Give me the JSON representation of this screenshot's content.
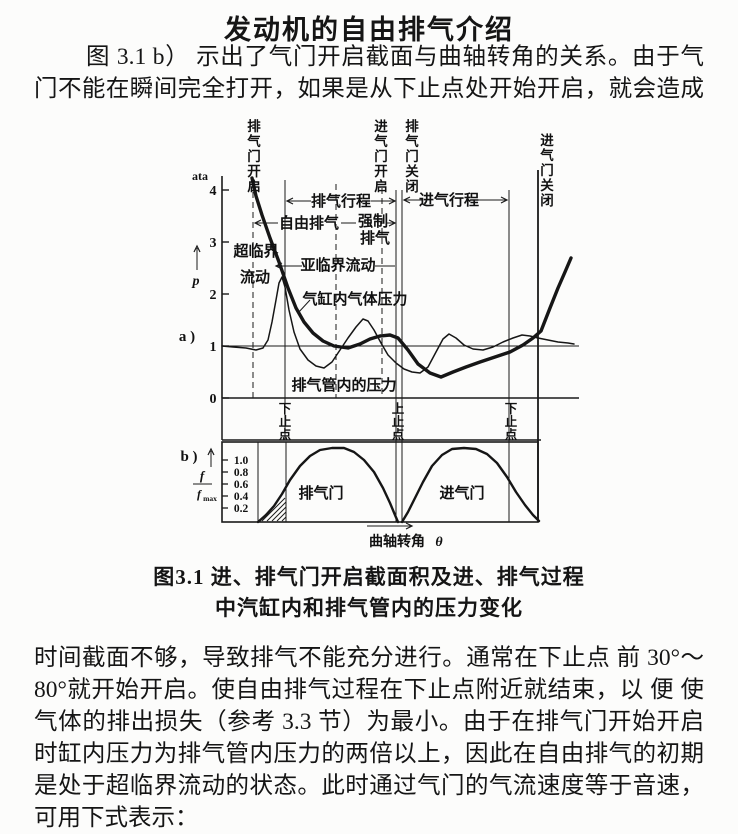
{
  "page": {
    "title": "发动机的自由排气介绍",
    "para1_lines": [
      "图 3.1 b） 示出了气门开启截面与曲轴转角的关系。由于气",
      "门不能在瞬间完全打开，如果是从下止点处开始开启，就会造成"
    ],
    "para2_lines": [
      "时间截面不够，导致排气不能充分进行。通常在下止点 前 30°～",
      "80°就开始开启。使自由排气过程在下止点附近就结束，以 便 使",
      "气体的排出损失（参考 3.3 节）为最小。由于在排气门开始开启",
      "时缸内压力为排气管内压力的两倍以上，因此在自由排气的初期",
      "是处于超临界流动的状态。此时通过气门的气流速度等于音速，",
      "可用下式表示："
    ],
    "caption_line1": "图3.1  进、排气门开启截面积及进、排气过程",
    "caption_line2": "中汽缸内和排气管内的压力变化"
  },
  "chart_data": {
    "type": "line",
    "title": "进、排气门开启截面积及进、排气过程中汽缸内和排气管内的压力变化",
    "subplot_a": {
      "ylabel": "p (ata)",
      "yticks": [
        0,
        1,
        2,
        3,
        4
      ],
      "ylim": [
        0,
        4.5
      ],
      "x_axis": "曲轴转角（无数值刻度，以事件线标注）",
      "events": [
        "排气门开启",
        "下止点",
        "进气门开启",
        "上止点 / 排气门关闭",
        "下止点",
        "进气门关闭"
      ],
      "regions": [
        "自由排气",
        "强制排气",
        "排气行程",
        "进气行程",
        "超临界流动",
        "亚临界流动"
      ],
      "series": [
        {
          "name": "气缸内气体压力",
          "approx_atm_at_events": [
            4.2,
            2.1,
            1.2,
            1.15,
            0.95,
            1.3
          ]
        },
        {
          "name": "排气管内的压力",
          "approx_atm_at_events": [
            1.0,
            2.35,
            1.0,
            1.1,
            1.05,
            1.0
          ]
        }
      ]
    },
    "subplot_b": {
      "ylabel": "f/fmax",
      "yticks": [
        0.2,
        0.4,
        0.6,
        0.8,
        1.0
      ],
      "xlabel": "曲轴转角 θ",
      "curves": [
        "排气门",
        "进气门"
      ],
      "description": "两条钟形开启截面曲线；排气门在下止点前开启（起始段为阴影区），上止点处排气门关闭、进气门开启，进气门在第二个下止点后关闭"
    }
  },
  "figure": {
    "unit_label": "ata",
    "p_label": "p",
    "panel_a": "a )",
    "panel_b": "b )",
    "axis_a": {
      "x": 224,
      "ytop": 176,
      "ybot": 398,
      "ticks": [
        {
          "t": "4",
          "y": 190
        },
        {
          "t": "3",
          "y": 242
        },
        {
          "t": "2",
          "y": 294
        },
        {
          "t": "1",
          "y": 346
        },
        {
          "t": "0",
          "y": 398
        }
      ]
    },
    "ref_y": 346,
    "base_y": 398,
    "strip_bot": 440,
    "x_left": 224,
    "x_right": 540,
    "x_end": 581,
    "b_box": {
      "x1": 224,
      "x2": 540,
      "y1": 442,
      "y2": 522
    },
    "b_ticks": [
      {
        "t": "1.0",
        "y": 460
      },
      {
        "t": "0.8",
        "y": 472
      },
      {
        "t": "0.6",
        "y": 484
      },
      {
        "t": "0.4",
        "y": 496
      },
      {
        "t": "0.2",
        "y": 508
      }
    ],
    "f_frac": {
      "top": "f",
      "bot": "f",
      "sub": "max"
    },
    "vlines": [
      {
        "x": 255,
        "y1": 182,
        "y2": 398,
        "dash": true
      },
      {
        "x": 287,
        "y1": 180,
        "y2": 440,
        "dash": false
      },
      {
        "x": 338,
        "y1": 184,
        "y2": 398,
        "dash": true
      },
      {
        "x": 384,
        "y1": 188,
        "y2": 398,
        "dash": true
      },
      {
        "x": 398,
        "y1": 190,
        "y2": 522,
        "dash": false
      },
      {
        "x": 404,
        "y1": 190,
        "y2": 522,
        "dash": false
      },
      {
        "x": 511,
        "y1": 190,
        "y2": 522,
        "dash": false
      },
      {
        "x": 540,
        "y1": 170,
        "y2": 522,
        "dash": false,
        "w": 1.8
      },
      {
        "x": 260,
        "y1": 442,
        "y2": 522,
        "dash": false
      },
      {
        "x": 288,
        "y1": 442,
        "y2": 522,
        "dash": false
      }
    ],
    "top_labels": [
      {
        "t": "排气门开启",
        "x": 256,
        "y": 131
      },
      {
        "t": "进气门开启",
        "x": 383,
        "y": 131
      },
      {
        "t": "排气门关闭",
        "x": 414,
        "y": 131
      },
      {
        "t": "进气门关闭",
        "x": 549,
        "y": 145
      }
    ],
    "dead_labels": [
      {
        "t": "下止点",
        "x": 287,
        "y": 413
      },
      {
        "t": "上止点",
        "x": 400,
        "y": 413
      },
      {
        "t": "下止点",
        "x": 513,
        "y": 413
      }
    ],
    "annotations": [
      {
        "t": "排气行程",
        "x": 343,
        "y": 206,
        "s": 15
      },
      {
        "t": "进气行程",
        "x": 451,
        "y": 205,
        "s": 15
      },
      {
        "t": "自由排气",
        "x": 311,
        "y": 228,
        "s": 15
      },
      {
        "t": "强制",
        "x": 375,
        "y": 226,
        "s": 15
      },
      {
        "t": "排气",
        "x": 377,
        "y": 243,
        "s": 15
      },
      {
        "t": "超临界",
        "x": 258,
        "y": 256,
        "s": 15
      },
      {
        "t": "流动",
        "x": 257,
        "y": 282,
        "s": 15
      },
      {
        "t": "亚临界流动",
        "x": 340,
        "y": 270,
        "s": 15
      },
      {
        "t": "气缸内气体压力",
        "x": 357,
        "y": 304,
        "s": 15
      },
      {
        "t": "排气管内的压力",
        "x": 346,
        "y": 390,
        "s": 15
      },
      {
        "t": "排气门",
        "x": 323,
        "y": 498,
        "s": 15
      },
      {
        "t": "进气门",
        "x": 464,
        "y": 498,
        "s": 15
      },
      {
        "t": "曲轴转角",
        "x": 399,
        "y": 546,
        "s": 14
      },
      {
        "t": "θ",
        "x": 441,
        "y": 546,
        "s": 14,
        "i": true
      }
    ],
    "arrows": [
      {
        "x1": 289,
        "y1": 201,
        "x2": 313,
        "y2": 201,
        "h": "l"
      },
      {
        "x1": 373,
        "y1": 201,
        "x2": 397,
        "y2": 201,
        "h": "r"
      },
      {
        "x1": 406,
        "y1": 200,
        "x2": 425,
        "y2": 200,
        "h": "l"
      },
      {
        "x1": 477,
        "y1": 200,
        "x2": 509,
        "y2": 200,
        "h": "r"
      },
      {
        "x1": 257,
        "y1": 223,
        "x2": 280,
        "y2": 223,
        "h": "l"
      },
      {
        "x1": 343,
        "y1": 223,
        "x2": 358,
        "y2": 223,
        "h": ""
      },
      {
        "x1": 389,
        "y1": 223,
        "x2": 397,
        "y2": 223,
        "h": "r"
      },
      {
        "x1": 278,
        "y1": 266,
        "x2": 304,
        "y2": 266,
        "h": "l"
      },
      {
        "x1": 377,
        "y1": 266,
        "x2": 397,
        "y2": 266,
        "h": ""
      },
      {
        "x1": 312,
        "y1": 300,
        "x2": 300,
        "y2": 313,
        "h": ""
      },
      {
        "x1": 369,
        "y1": 526,
        "x2": 414,
        "y2": 526,
        "h": "r"
      }
    ],
    "curve_cylinder": [
      [
        254,
        178
      ],
      [
        258,
        196
      ],
      [
        264,
        215
      ],
      [
        272,
        238
      ],
      [
        281,
        262
      ],
      [
        290,
        288
      ],
      [
        298,
        308
      ],
      [
        306,
        322
      ],
      [
        315,
        333
      ],
      [
        325,
        341
      ],
      [
        336,
        346
      ],
      [
        350,
        348
      ],
      [
        362,
        344
      ],
      [
        372,
        339
      ],
      [
        382,
        336
      ],
      [
        392,
        335
      ],
      [
        400,
        338
      ],
      [
        410,
        350
      ],
      [
        420,
        364
      ],
      [
        432,
        373
      ],
      [
        443,
        377
      ],
      [
        455,
        372
      ],
      [
        468,
        367
      ],
      [
        482,
        362
      ],
      [
        497,
        357
      ],
      [
        512,
        352
      ],
      [
        525,
        345
      ],
      [
        535,
        338
      ],
      [
        543,
        331
      ],
      [
        552,
        308
      ],
      [
        560,
        288
      ],
      [
        567,
        272
      ],
      [
        573,
        258
      ]
    ],
    "curve_pipe": [
      [
        224,
        346
      ],
      [
        235,
        347
      ],
      [
        248,
        348
      ],
      [
        258,
        350
      ],
      [
        265,
        348
      ],
      [
        270,
        340
      ],
      [
        274,
        322
      ],
      [
        278,
        300
      ],
      [
        281,
        283
      ],
      [
        284,
        277
      ],
      [
        287,
        287
      ],
      [
        291,
        310
      ],
      [
        296,
        332
      ],
      [
        302,
        349
      ],
      [
        310,
        360
      ],
      [
        318,
        366
      ],
      [
        326,
        368
      ],
      [
        334,
        362
      ],
      [
        342,
        350
      ],
      [
        350,
        338
      ],
      [
        358,
        327
      ],
      [
        365,
        319
      ],
      [
        370,
        321
      ],
      [
        376,
        330
      ],
      [
        383,
        343
      ],
      [
        390,
        355
      ],
      [
        398,
        363
      ],
      [
        406,
        369
      ],
      [
        414,
        372
      ],
      [
        422,
        373
      ],
      [
        430,
        367
      ],
      [
        438,
        352
      ],
      [
        445,
        339
      ],
      [
        451,
        334
      ],
      [
        458,
        338
      ],
      [
        466,
        345
      ],
      [
        475,
        349
      ],
      [
        485,
        350
      ],
      [
        495,
        347
      ],
      [
        505,
        342
      ],
      [
        515,
        338
      ],
      [
        524,
        335
      ],
      [
        532,
        336
      ],
      [
        540,
        338
      ],
      [
        550,
        340
      ],
      [
        560,
        342
      ],
      [
        570,
        343
      ],
      [
        576,
        344
      ]
    ],
    "curve_exhaust_valve": [
      [
        260,
        522
      ],
      [
        268,
        515
      ],
      [
        276,
        506
      ],
      [
        284,
        494
      ],
      [
        292,
        480
      ],
      [
        302,
        466
      ],
      [
        312,
        456
      ],
      [
        322,
        450
      ],
      [
        334,
        448
      ],
      [
        346,
        448
      ],
      [
        356,
        452
      ],
      [
        366,
        460
      ],
      [
        376,
        472
      ],
      [
        385,
        488
      ],
      [
        392,
        503
      ],
      [
        397,
        515
      ],
      [
        400,
        522
      ]
    ],
    "curve_intake_valve": [
      [
        404,
        522
      ],
      [
        410,
        512
      ],
      [
        417,
        498
      ],
      [
        425,
        482
      ],
      [
        434,
        466
      ],
      [
        444,
        455
      ],
      [
        454,
        449
      ],
      [
        466,
        448
      ],
      [
        478,
        449
      ],
      [
        489,
        454
      ],
      [
        499,
        463
      ],
      [
        509,
        477
      ],
      [
        518,
        492
      ],
      [
        527,
        505
      ],
      [
        535,
        515
      ],
      [
        541,
        521
      ]
    ],
    "hatch": [
      [
        261,
        521,
        272,
        510
      ],
      [
        264,
        521,
        287,
        498
      ],
      [
        269,
        521,
        288,
        502
      ],
      [
        274,
        521,
        288,
        507
      ],
      [
        279,
        521,
        288,
        512
      ],
      [
        284,
        521,
        288,
        517
      ]
    ]
  }
}
